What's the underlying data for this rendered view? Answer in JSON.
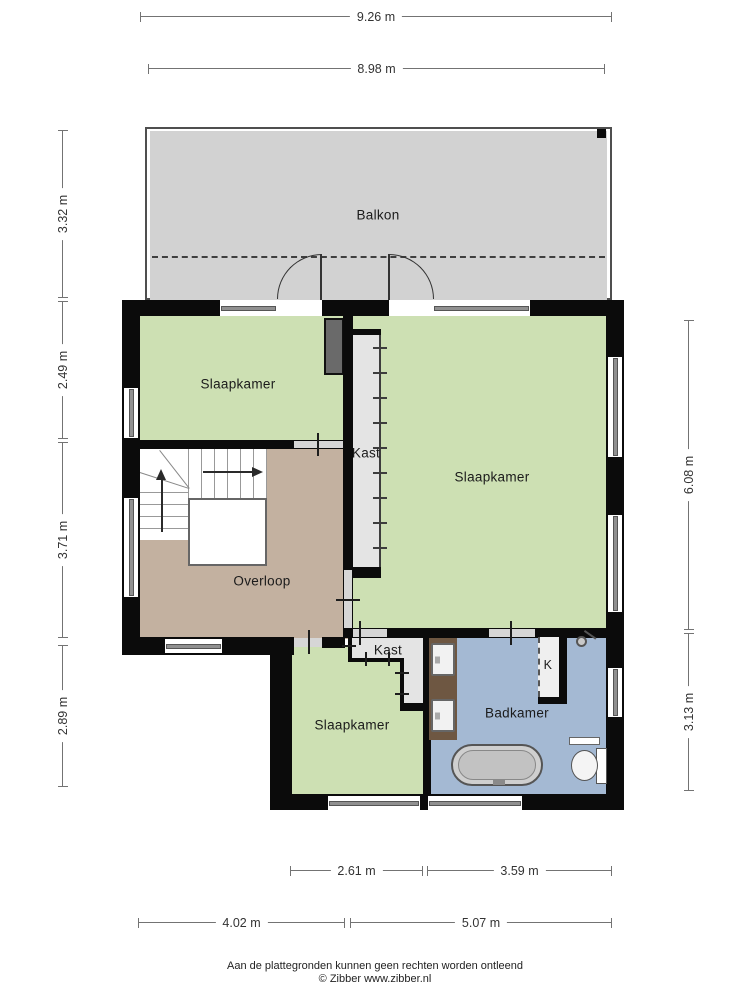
{
  "rooms": {
    "balkon": "Balkon",
    "slaapkamer_top_left": "Slaapkamer",
    "slaapkamer_right": "Slaapkamer",
    "slaapkamer_bottom": "Slaapkamer",
    "overloop": "Overloop",
    "kast_middle": "Kast",
    "kast_bottom": "Kast",
    "badkamer": "Badkamer",
    "kast_small": "K"
  },
  "dims": {
    "top_outer": "9.26 m",
    "top_inner": "8.98 m",
    "left_balkon": "3.32 m",
    "left_upper": "2.49 m",
    "left_middle": "3.71 m",
    "left_lower": "2.89 m",
    "right_upper": "6.08 m",
    "right_lower": "3.13 m",
    "bottom_inner_left": "2.61 m",
    "bottom_inner_right": "3.59 m",
    "bottom_outer_left": "4.02 m",
    "bottom_outer_right": "5.07 m"
  },
  "footer": {
    "disclaimer": "Aan de plattegronden kunnen geen rechten worden ontleend",
    "credit": "© Zibber www.zibber.nl"
  },
  "colors": {
    "bedroom_green": "#cde0b3",
    "hallway_tan": "#c3b1a0",
    "bathroom_blue": "#a4b9d3",
    "closet_gray": "#e4e4e4",
    "balcony_gray": "#d2d2d2",
    "wall_black": "#0b0b0b",
    "counter_wood": "#6e5742"
  }
}
